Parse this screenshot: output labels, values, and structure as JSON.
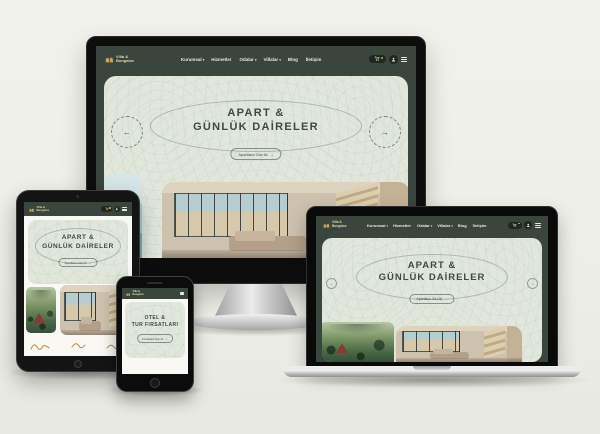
{
  "brand": {
    "line1": "Villa &",
    "line2": "Bungalov"
  },
  "nav": {
    "items": [
      {
        "label": "Kurumsal",
        "caret": "▾"
      },
      {
        "label": "Hizmetler",
        "caret": ""
      },
      {
        "label": "Odalar",
        "caret": "▾"
      },
      {
        "label": "Villalar",
        "caret": "▾"
      },
      {
        "label": "Blog",
        "caret": ""
      },
      {
        "label": "İletişim",
        "caret": ""
      }
    ]
  },
  "hero": {
    "title_line1": "APART &",
    "title_line2": "GÜNLÜK DAİRELER",
    "cta": "Apartlara Göz At",
    "cta_arrow": "→",
    "prev_arrow": "←",
    "next_arrow": "→"
  },
  "phone_hero": {
    "title_line1": "OTEL &",
    "title_line2": "TUR FIRSATLARI",
    "cta": "Fırsatlara Göz At",
    "cta_arrow": "→"
  },
  "icons": {
    "logo": "villa-logo-icon",
    "cart": "cart-icon",
    "user": "user-icon",
    "menu": "hamburger-icon",
    "partner_logos": [
      "script-logo-1",
      "script-logo-2",
      "script-logo-3"
    ]
  },
  "colors": {
    "page_bg": "#f0f1ea",
    "navbar_green": "#39453d",
    "hero_sage": "#e1e8db",
    "text_dark": "#3d4a41",
    "gold": "#c9a457",
    "device_black": "#0d0d0d"
  }
}
